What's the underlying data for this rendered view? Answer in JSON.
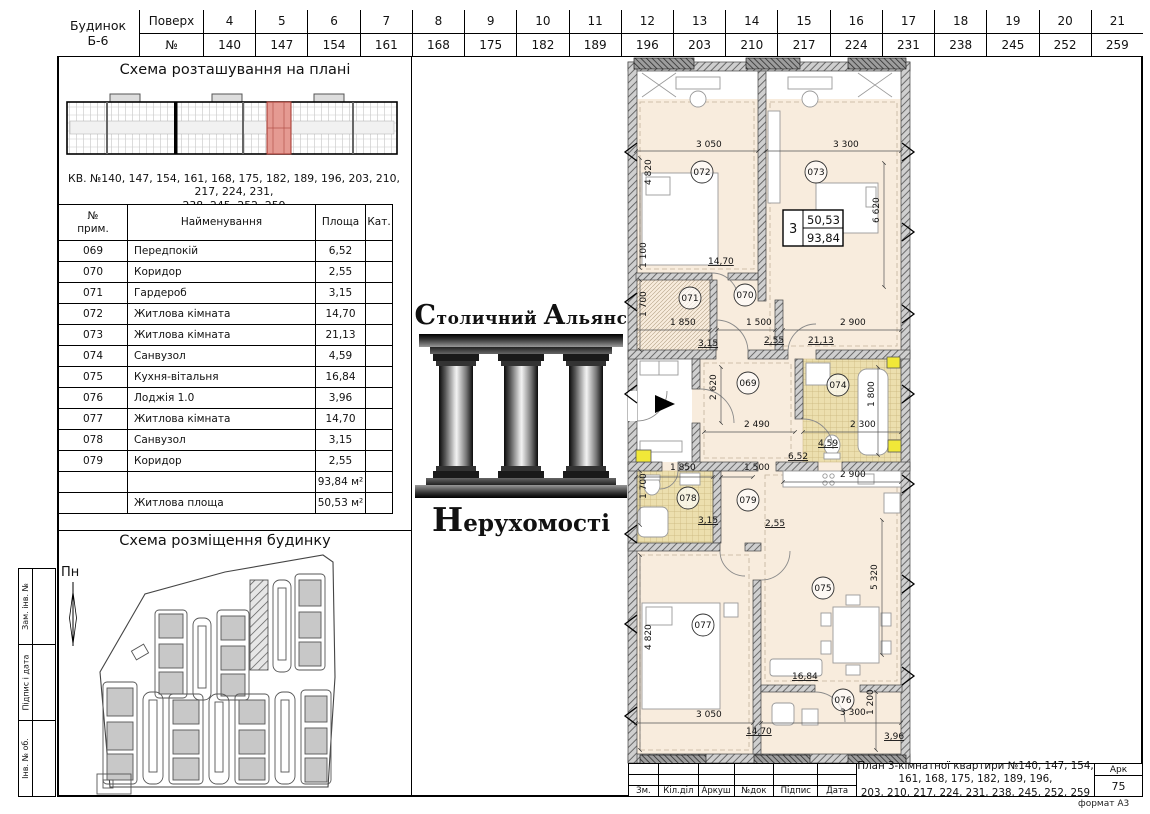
{
  "sheet": {
    "format_label": "формат А3"
  },
  "colors": {
    "highlight_pink": "#e59a92",
    "room_fill": "#f8ecdd",
    "tile_fill": "#ecdfae",
    "shaft_yellow": "#f1e838",
    "wall_gray": "#cfcfcf"
  },
  "floors_table": {
    "building_label": "Будинок",
    "building_code": "Б-6",
    "floor_header": "Поверх",
    "number_header": "№",
    "columns": [
      {
        "floor": "4",
        "num": "140"
      },
      {
        "floor": "5",
        "num": "147"
      },
      {
        "floor": "6",
        "num": "154"
      },
      {
        "floor": "7",
        "num": "161"
      },
      {
        "floor": "8",
        "num": "168"
      },
      {
        "floor": "9",
        "num": "175"
      },
      {
        "floor": "10",
        "num": "182"
      },
      {
        "floor": "11",
        "num": "189"
      },
      {
        "floor": "12",
        "num": "196"
      },
      {
        "floor": "13",
        "num": "203"
      },
      {
        "floor": "14",
        "num": "210"
      },
      {
        "floor": "15",
        "num": "217"
      },
      {
        "floor": "16",
        "num": "224"
      },
      {
        "floor": "17",
        "num": "231"
      },
      {
        "floor": "18",
        "num": "238"
      },
      {
        "floor": "19",
        "num": "245"
      },
      {
        "floor": "20",
        "num": "252"
      },
      {
        "floor": "21",
        "num": "259"
      }
    ]
  },
  "location_scheme": {
    "title": "Схема розташування на плані",
    "note_line1": "КВ. №140, 147, 154, 161, 168, 175, 182, 189, 196, 203, 210, 217, 224, 231,",
    "note_line2": "238, 245, 252, 259"
  },
  "rooms_table": {
    "headers": {
      "num_line1": "№",
      "num_line2": "прим.",
      "name": "Найменування",
      "area": "Площа",
      "cat": "Кат."
    },
    "rows": [
      {
        "num": "069",
        "name": "Передпокій",
        "area": "6,52",
        "cat": ""
      },
      {
        "num": "070",
        "name": "Коридор",
        "area": "2,55",
        "cat": ""
      },
      {
        "num": "071",
        "name": "Гардероб",
        "area": "3,15",
        "cat": ""
      },
      {
        "num": "072",
        "name": "Житлова кімната",
        "area": "14,70",
        "cat": ""
      },
      {
        "num": "073",
        "name": "Житлова кімната",
        "area": "21,13",
        "cat": ""
      },
      {
        "num": "074",
        "name": "Санвузол",
        "area": "4,59",
        "cat": ""
      },
      {
        "num": "075",
        "name": "Кухня-вітальня",
        "area": "16,84",
        "cat": ""
      },
      {
        "num": "076",
        "name": "Лоджія 1.0",
        "area": "3,96",
        "cat": ""
      },
      {
        "num": "077",
        "name": "Житлова кімната",
        "area": "14,70",
        "cat": ""
      },
      {
        "num": "078",
        "name": "Санвузол",
        "area": "3,15",
        "cat": ""
      },
      {
        "num": "079",
        "name": "Коридор",
        "area": "2,55",
        "cat": ""
      }
    ],
    "total_area": "93,84 м²",
    "living_label": "Житлова площа",
    "living_area": "50,53 м²"
  },
  "logo": {
    "ini1": "С",
    "rest1": "толичний",
    "ini2": "А",
    "rest2": "льянс",
    "ini3": "Н",
    "rest3": "ерухомості"
  },
  "site_scheme": {
    "title": "Схема розміщення будинку",
    "north_label": "Пн"
  },
  "side_strip": {
    "cells": [
      "Зам. інв. №",
      "Підпис і дата",
      "Інв. № об."
    ]
  },
  "title_block": {
    "columns": [
      "Зм.",
      "Кіл.діл",
      "Аркуш",
      "№док",
      "Підпис",
      "Дата"
    ],
    "description_line1": "План 3-кімнатної квартири №140, 147, 154, 161, 168, 175, 182, 189, 196,",
    "description_line2": "203, 210, 217, 224, 231, 238, 245, 252, 259",
    "sheet_header": "Арк",
    "sheet_number": "75"
  },
  "plan": {
    "badge": {
      "rooms": "3",
      "living": "50,53",
      "total": "93,84"
    },
    "rooms": [
      {
        "num": "069",
        "x": 128,
        "y": 328
      },
      {
        "num": "070",
        "x": 125,
        "y": 240
      },
      {
        "num": "071",
        "x": 70,
        "y": 243
      },
      {
        "num": "072",
        "x": 82,
        "y": 117
      },
      {
        "num": "073",
        "x": 196,
        "y": 117
      },
      {
        "num": "074",
        "x": 218,
        "y": 330
      },
      {
        "num": "075",
        "x": 203,
        "y": 533
      },
      {
        "num": "076",
        "x": 223,
        "y": 645
      },
      {
        "num": "077",
        "x": 83,
        "y": 570
      },
      {
        "num": "078",
        "x": 68,
        "y": 443
      },
      {
        "num": "079",
        "x": 128,
        "y": 445
      }
    ],
    "labels": [
      {
        "text": "3 050",
        "x": 76,
        "y": 92
      },
      {
        "text": "3 300",
        "x": 213,
        "y": 92
      },
      {
        "text": "4 820",
        "x": 31,
        "y": 130,
        "rot": -90
      },
      {
        "text": "6 620",
        "x": 259,
        "y": 168,
        "rot": -90
      },
      {
        "text": "14,70",
        "x": 88,
        "y": 209,
        "area": true
      },
      {
        "text": "1 100",
        "x": 26,
        "y": 213,
        "rot": -90
      },
      {
        "text": "1 700",
        "x": 26,
        "y": 262,
        "rot": -90
      },
      {
        "text": "1 850",
        "x": 50,
        "y": 270
      },
      {
        "text": "1 500",
        "x": 126,
        "y": 270
      },
      {
        "text": "2 900",
        "x": 220,
        "y": 270
      },
      {
        "text": "3,15",
        "x": 78,
        "y": 291,
        "area": true
      },
      {
        "text": "2,55",
        "x": 144,
        "y": 288,
        "area": true
      },
      {
        "text": "21,13",
        "x": 188,
        "y": 288,
        "area": true
      },
      {
        "text": "2 620",
        "x": 96,
        "y": 345,
        "rot": -90
      },
      {
        "text": "2 490",
        "x": 124,
        "y": 372
      },
      {
        "text": "2 300",
        "x": 230,
        "y": 372
      },
      {
        "text": "1 800",
        "x": 254,
        "y": 352,
        "rot": -90
      },
      {
        "text": "4,59",
        "x": 198,
        "y": 391,
        "area": true
      },
      {
        "text": "6,52",
        "x": 168,
        "y": 404,
        "area": true
      },
      {
        "text": "1 850",
        "x": 50,
        "y": 415
      },
      {
        "text": "1 500",
        "x": 124,
        "y": 415
      },
      {
        "text": "2 900",
        "x": 220,
        "y": 422
      },
      {
        "text": "1 700",
        "x": 26,
        "y": 444,
        "rot": -90
      },
      {
        "text": "3,15",
        "x": 78,
        "y": 468,
        "area": true
      },
      {
        "text": "2,55",
        "x": 145,
        "y": 471,
        "area": true
      },
      {
        "text": "5 320",
        "x": 257,
        "y": 535,
        "rot": -90
      },
      {
        "text": "16,84",
        "x": 172,
        "y": 624,
        "area": true
      },
      {
        "text": "4 820",
        "x": 31,
        "y": 595,
        "rot": -90
      },
      {
        "text": "3 050",
        "x": 76,
        "y": 662
      },
      {
        "text": "14,70",
        "x": 126,
        "y": 679,
        "area": true
      },
      {
        "text": "3 300",
        "x": 220,
        "y": 660
      },
      {
        "text": "1 200",
        "x": 253,
        "y": 660,
        "rot": -90
      },
      {
        "text": "3,96",
        "x": 264,
        "y": 684,
        "area": true
      }
    ]
  }
}
